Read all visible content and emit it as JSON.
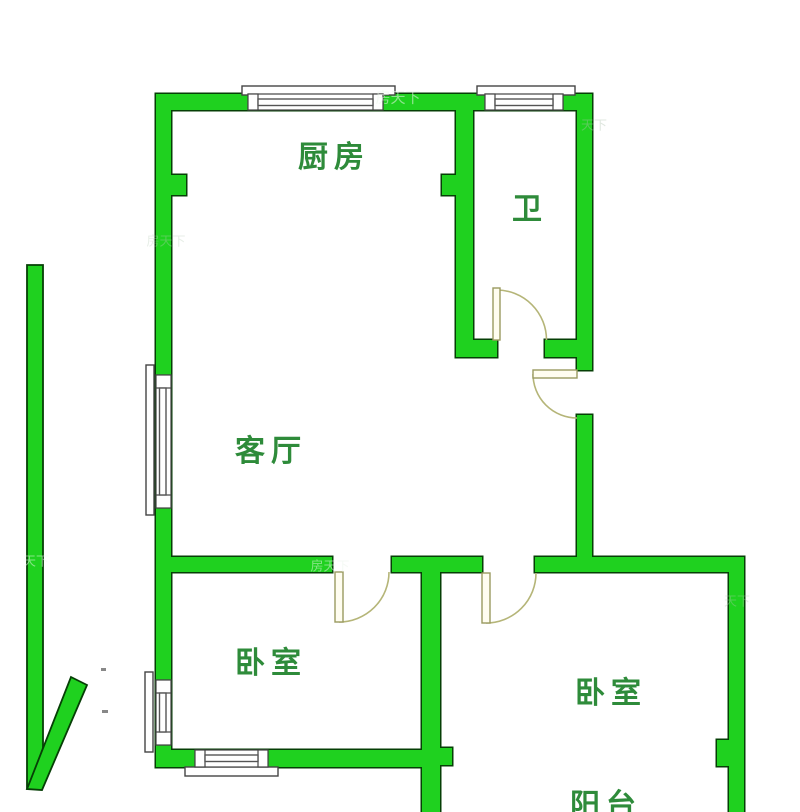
{
  "floorplan": {
    "title": "2室1厅1卫户型图",
    "rooms": {
      "kitchen": {
        "label": "厨房"
      },
      "bathroom": {
        "label": "卫"
      },
      "living_room": {
        "label": "客厅"
      },
      "bedroom_left": {
        "label": "卧室"
      },
      "bedroom_right": {
        "label": "卧室"
      },
      "balcony": {
        "label": "阳台"
      }
    },
    "watermarks": [
      {
        "text": "房天下"
      },
      {
        "text": "天下"
      },
      {
        "text": "房天下"
      },
      {
        "text": "天下"
      },
      {
        "text": "房天下"
      },
      {
        "text": "天下"
      }
    ],
    "colors": {
      "wall_fill": "#1fd11f",
      "wall_outline": "#063f06",
      "door_arc": "#b5b578",
      "door_leaf_fill": "#fffdf0",
      "window_frame": "#444444",
      "label_text": "#2e8b3a"
    }
  }
}
